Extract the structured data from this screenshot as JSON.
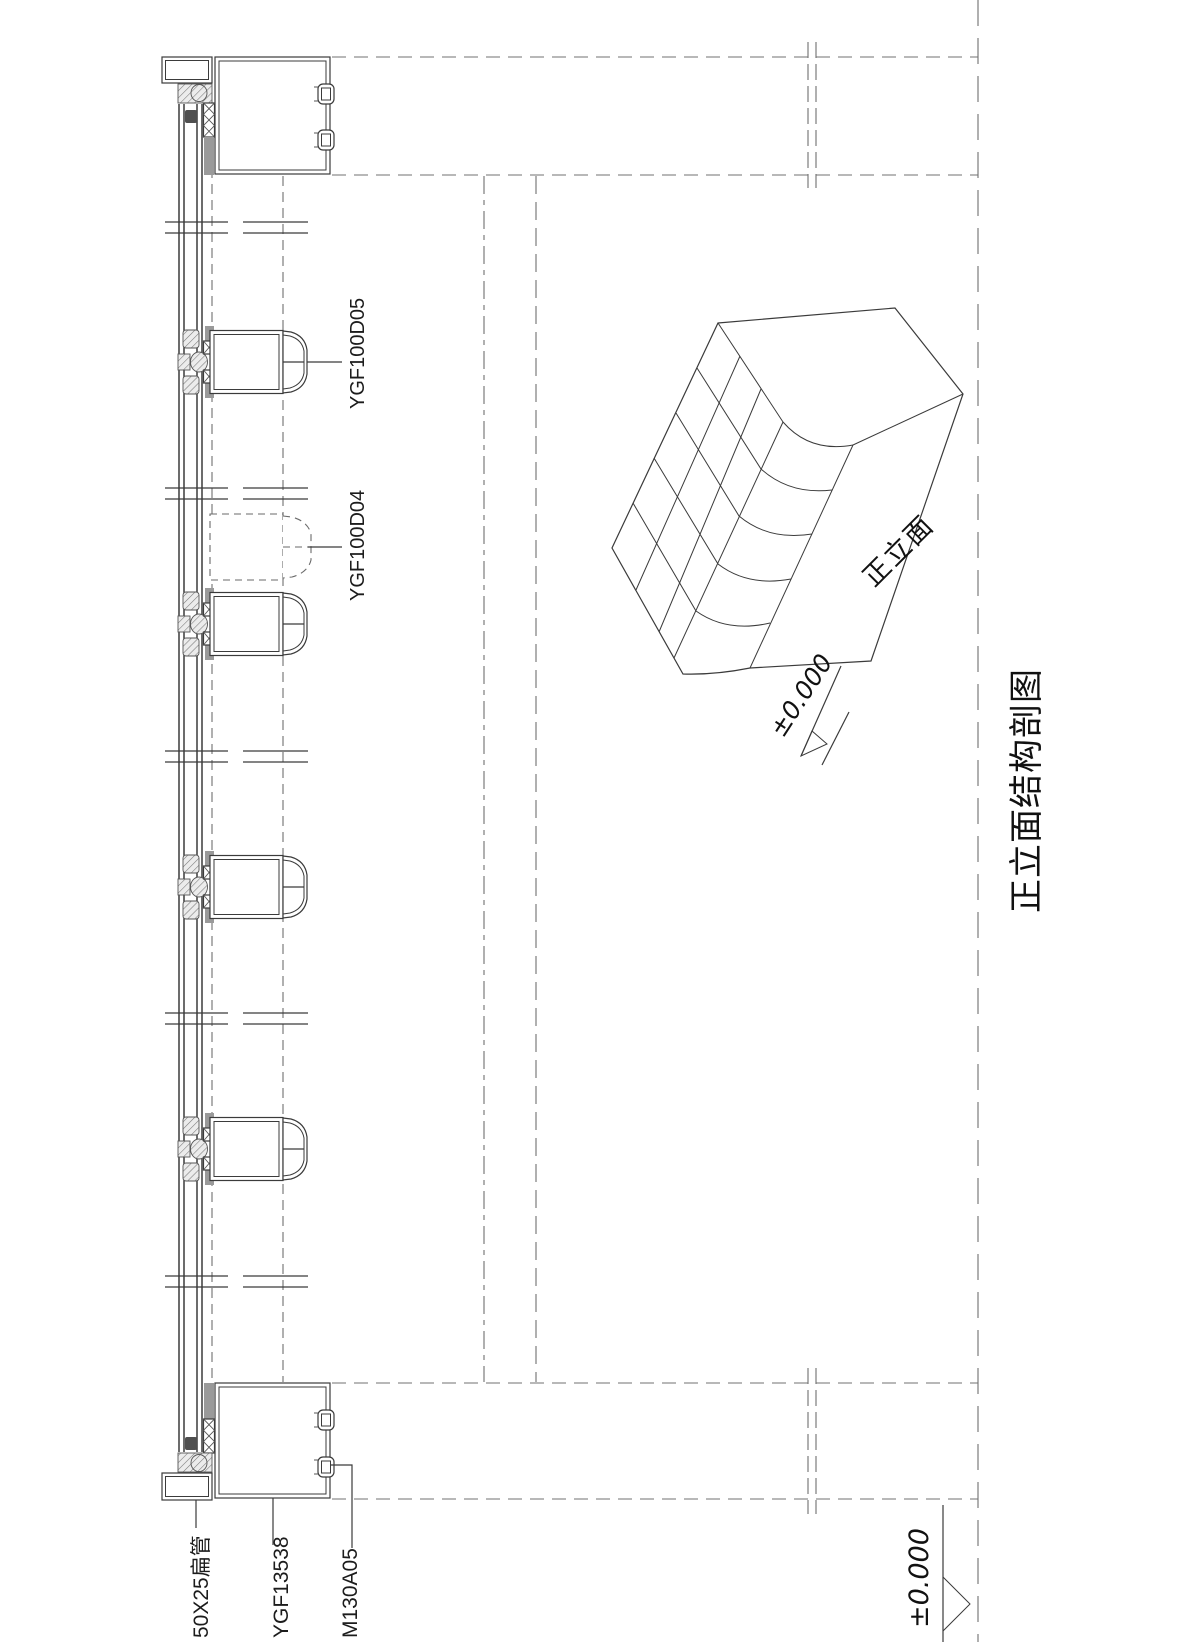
{
  "drawing": {
    "title": "正立面结构剖图",
    "section": {
      "label_mullion": "YGF100D05",
      "label_mullion_hidden": "YGF100D04",
      "label_flat_tube": "50X25扁管",
      "label_frame_profile": "YGF13538",
      "label_clip": "M130A05"
    },
    "isometric": {
      "face_label": "正立面",
      "level_label": "±0.000"
    },
    "level_label_bottom": "±0.000",
    "colors": {
      "line": "#3b3b3b",
      "hidden_line": "#707070",
      "gray_fill": "#9a9a9a",
      "dark_fill": "#4f4f4f",
      "background": "#ffffff"
    }
  }
}
